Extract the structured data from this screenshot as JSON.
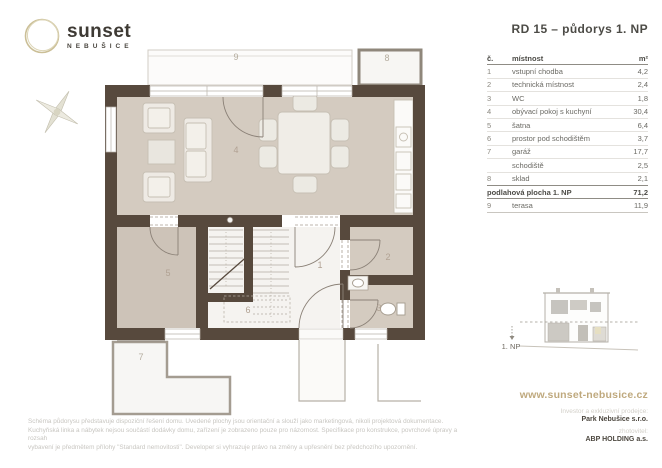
{
  "header": {
    "logo_text": "sunset",
    "logo_subtext": "NEBUŠICE",
    "title": "RD 15 – půdorys 1. NP"
  },
  "room_table": {
    "col_num": "č.",
    "col_name": "místnost",
    "col_area": "m²",
    "rows": [
      {
        "num": "1",
        "name": "vstupní chodba",
        "area": "4,2"
      },
      {
        "num": "2",
        "name": "technická místnost",
        "area": "2,4"
      },
      {
        "num": "3",
        "name": "WC",
        "area": "1,8"
      },
      {
        "num": "4",
        "name": "obývací pokoj s kuchyní",
        "area": "30,4"
      },
      {
        "num": "5",
        "name": "šatna",
        "area": "6,4"
      },
      {
        "num": "6",
        "name": "prostor pod schodištěm",
        "area": "3,7"
      },
      {
        "num": "7",
        "name": "garáž",
        "area": "17,7"
      },
      {
        "num": "",
        "name": "schodiště",
        "area": "2,5"
      },
      {
        "num": "8",
        "name": "sklad",
        "area": "2,1"
      }
    ],
    "total_label": "podlahová plocha 1. NP",
    "total_area": "71,2",
    "terrace_row": {
      "num": "9",
      "name": "terasa",
      "area": "11,9"
    }
  },
  "plan": {
    "room_labels": [
      "1",
      "2",
      "3",
      "4",
      "5",
      "6",
      "7",
      "8",
      "9"
    ],
    "floor_label": "1. NP"
  },
  "footer": {
    "website": "www.sunset-nebusice.cz",
    "investor_label": "Investor a exkluzivní prodejce:",
    "investor_name": "Park Nebušice s.r.o.",
    "builder_label": "zhotovitel:",
    "builder_name": "ABP HOLDING a.s.",
    "disclaimer": [
      "Schéma půdorysu představuje dispoziční řešení domu. Uvedené plochy jsou orientační a slouží jako marketingová, nikoli projektová dokumentace.",
      "Kuchyňská linka a nábytek nejsou součástí dodávky domu, zařízení je zobrazeno pouze pro názornost. Specifikace pro konstrukce, povrchové úpravy a rozsah",
      "vybavení je předmětem přílohy \"Standard nemovitosti\". Developer si vyhrazuje právo na změny a upřesnění bez předchozího upozornění."
    ]
  },
  "colors": {
    "accent_gold": "#bfa97e",
    "wall_brown": "#57493d",
    "room_beige": "#d4cbc0",
    "room_beige_2": "#cdc3b8",
    "text_dark": "#4c4b46",
    "text_muted": "#6b6a64",
    "text_faint": "#c8c6c1",
    "outline_gray": "#a49c91"
  }
}
